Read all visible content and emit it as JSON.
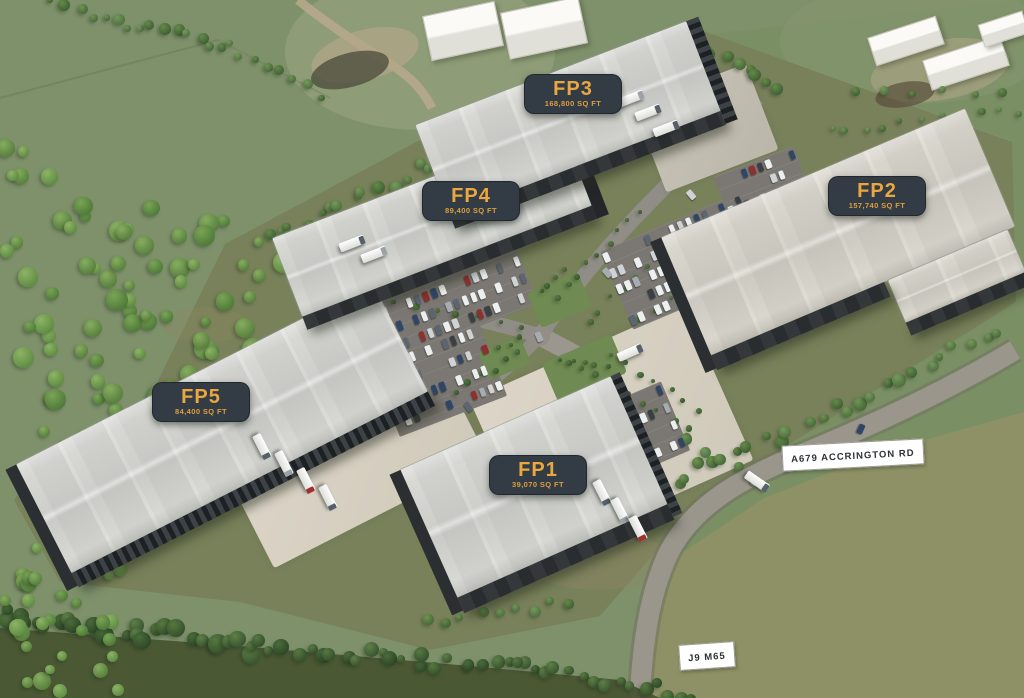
{
  "site": {
    "plots": [
      {
        "id": "FP1",
        "area": "39,070 SQ FT"
      },
      {
        "id": "FP2",
        "area": "157,740 SQ FT"
      },
      {
        "id": "FP3",
        "area": "168,800 SQ FT"
      },
      {
        "id": "FP4",
        "area": "89,400 SQ FT"
      },
      {
        "id": "FP5",
        "area": "84,400 SQ FT"
      }
    ],
    "road_signs": [
      {
        "id": "a679",
        "label": "A679 ACCRINGTON RD"
      },
      {
        "id": "j9m65",
        "label": "J9 M65"
      }
    ],
    "colors": {
      "badge_bg": "#333c44",
      "badge_text": "#eaa73f",
      "sign_bg": "#ffffff",
      "sign_text": "#2e3236"
    }
  }
}
